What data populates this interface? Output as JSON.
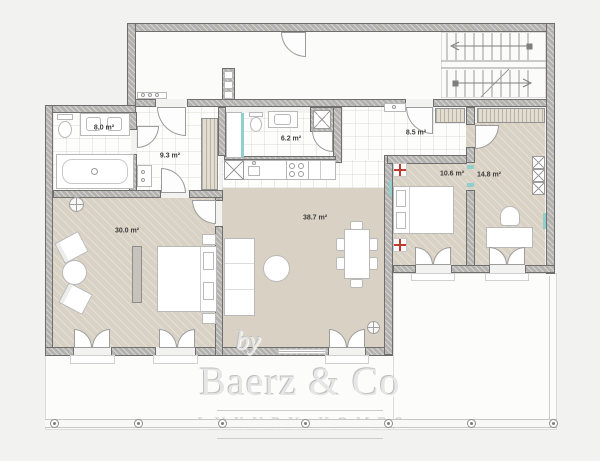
{
  "watermark": {
    "prefix": "by",
    "name": "Baerz & Co",
    "tagline": "LUXURY HOMES"
  },
  "rooms": [
    {
      "id": "bathroom-1",
      "label": "8.0 m²"
    },
    {
      "id": "hallway",
      "label": "9.3 m²"
    },
    {
      "id": "bathroom-2",
      "label": "6.2 m²"
    },
    {
      "id": "landing-hall",
      "label": "8.5 m²"
    },
    {
      "id": "bedroom-2",
      "label": "10.6 m²"
    },
    {
      "id": "bedroom-3",
      "label": "14.8 m²"
    },
    {
      "id": "master-bedroom",
      "label": "30.0 m²"
    },
    {
      "id": "living-room",
      "label": "38.7 m²"
    }
  ],
  "palette": {
    "background": "#f2f2f0",
    "wall": "#b3b2af",
    "warm_floor": "#d9d2c4",
    "accent_teal": "#8fd0cc",
    "accent_red": "#c23b2e",
    "watermark": "#e6e6e6"
  }
}
